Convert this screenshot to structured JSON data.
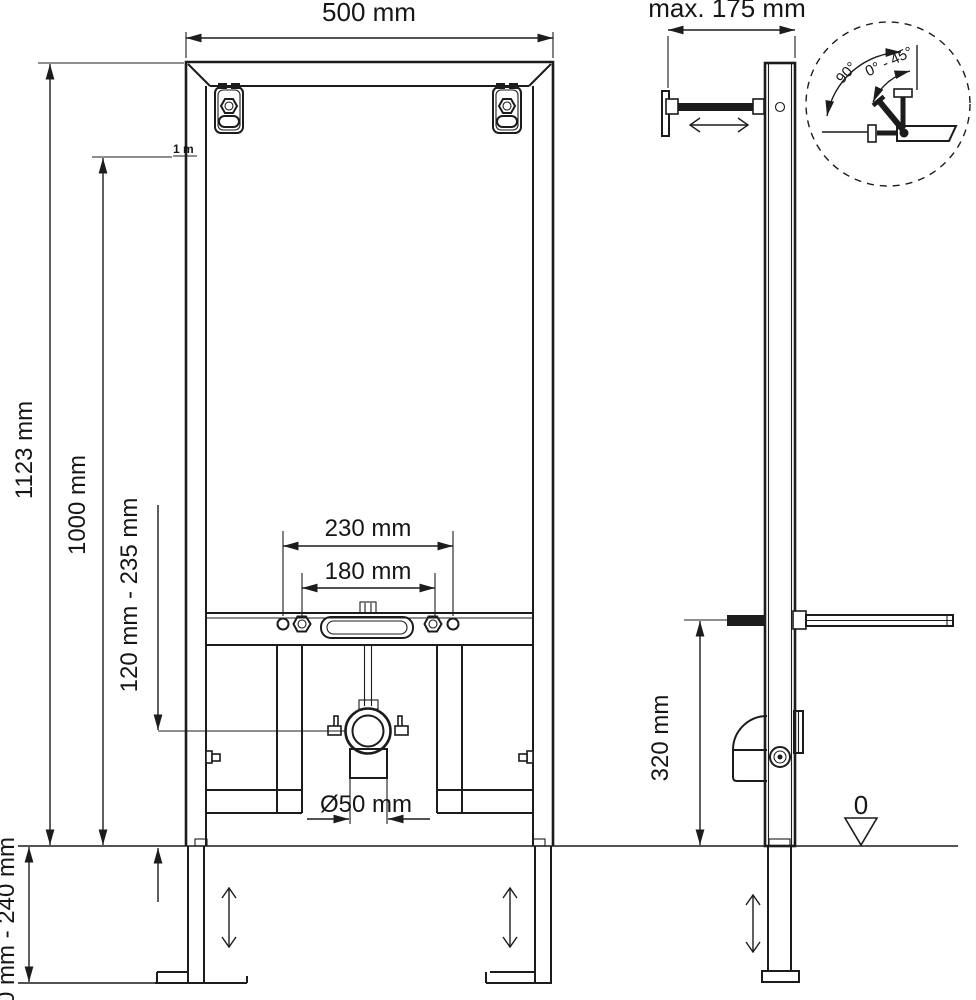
{
  "drawing": {
    "description": "Installation drawing of a wall mounting frame (front view, side view and angle-adjustment detail)",
    "line_color": "#1c1c1c",
    "front": {
      "width": "500 mm",
      "total_height": "1123 mm",
      "meter_height": "1000 mm",
      "meter_mark": "1 m",
      "fixture_height": "120 mm - 235 mm",
      "holes_outer": "230 mm",
      "holes_inner": "180 mm",
      "drain": "Ø50 mm",
      "feet_range": "0 mm - 240 mm"
    },
    "side": {
      "wall_distance": "max. 175 mm",
      "rod_height": "320 mm",
      "datum": "0"
    },
    "detail": {
      "angle_max": "90°",
      "angle_range": "0° - 45°"
    }
  }
}
